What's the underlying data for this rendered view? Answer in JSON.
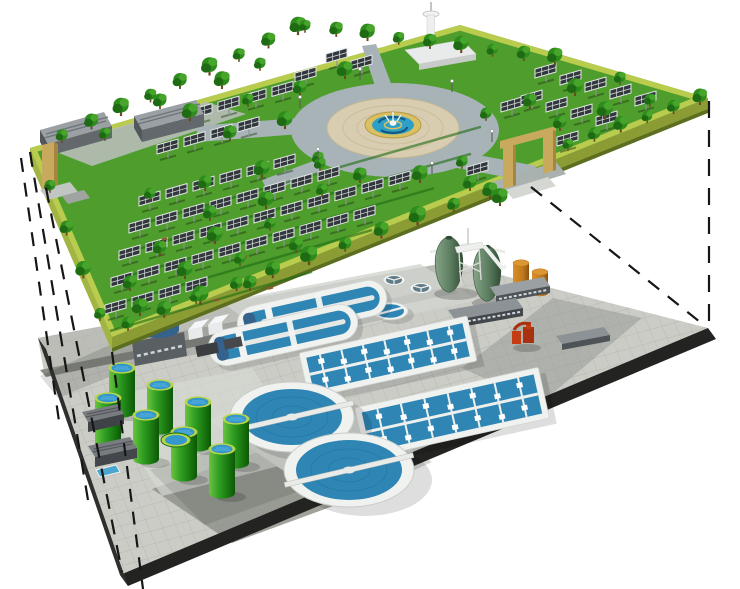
{
  "scene": {
    "kind": "isometric-cutaway-illustration",
    "subject": "underground wastewater treatment plant beneath a solar park",
    "upper_level": {
      "label": "solar-park-ground-level",
      "components": {
        "solar_panel_field": "rows of tilted photovoltaic panels on posts",
        "trees": "green park trees along edges and between panel rows",
        "central_plaza": "circular ring road with paved circle and fountain",
        "fountain": 1,
        "observation_tower": 1,
        "service_buildings": 2,
        "entrance_gates": 2
      }
    },
    "lower_level": {
      "label": "underground-treatment-plant",
      "components": {
        "digester_eggs": 2,
        "fuel_silos_orange": 2,
        "storage_tanks_green": 8,
        "large_circular_clarifiers": 2,
        "medium_circular_clarifiers": 2,
        "small_circular_tanks": 2,
        "oxidation_ditches": 2,
        "aeration_basins": 2,
        "ground_basin": 1,
        "blower_station": 1,
        "service_buildings": 3,
        "red_pump_unit": 1
      }
    },
    "projection_lines": "dashed lines linking park corners to the underground slab corners"
  },
  "colors": {
    "bg": "#ffffff",
    "lawn": "#4f9e2d",
    "lawn-light": "#63b13a",
    "park-band": "#b9cc4d",
    "park-side-left": "#a2b542",
    "park-side-right": "#8a9c33",
    "park-side-dark": "#5c6e1f",
    "tree": "#2e8c1c",
    "tree-dark": "#1f6b14",
    "tree-light": "#46a52a",
    "panel-dark": "#32373c",
    "panel-frame": "#e2e6e8",
    "road-ring": "#a7b3b6",
    "plaza-pave": "#d8cdb0",
    "fountain-ring": "#d9c063",
    "fountain-water": "#2e9fc6",
    "fountain-swirl": "#14597f",
    "gate-tan": "#c8a95e",
    "gate-tan-dark": "#a5853f",
    "bldg-roof": "#9aa0a4",
    "bldg-front": "#62686c",
    "pave-light": "#cbccc6",
    "pave-mid": "#b4b6af",
    "pave-dark": "#8f928b",
    "slab-edge": "#232422",
    "water": "#2f86b4",
    "clarifier-shell": "#f0f2f0",
    "tank-rim": "#b8d44b",
    "tank-water": "#3498cc",
    "tank-green": "#2f9e22",
    "tank-green-dark": "#15700d",
    "digester": "#5c7d60",
    "digester-dark": "#39563f",
    "silo-orange": "#c17a1c",
    "equip-red": "#c23c14",
    "blue-tank": "#35628c",
    "line-dark": "#161616"
  }
}
